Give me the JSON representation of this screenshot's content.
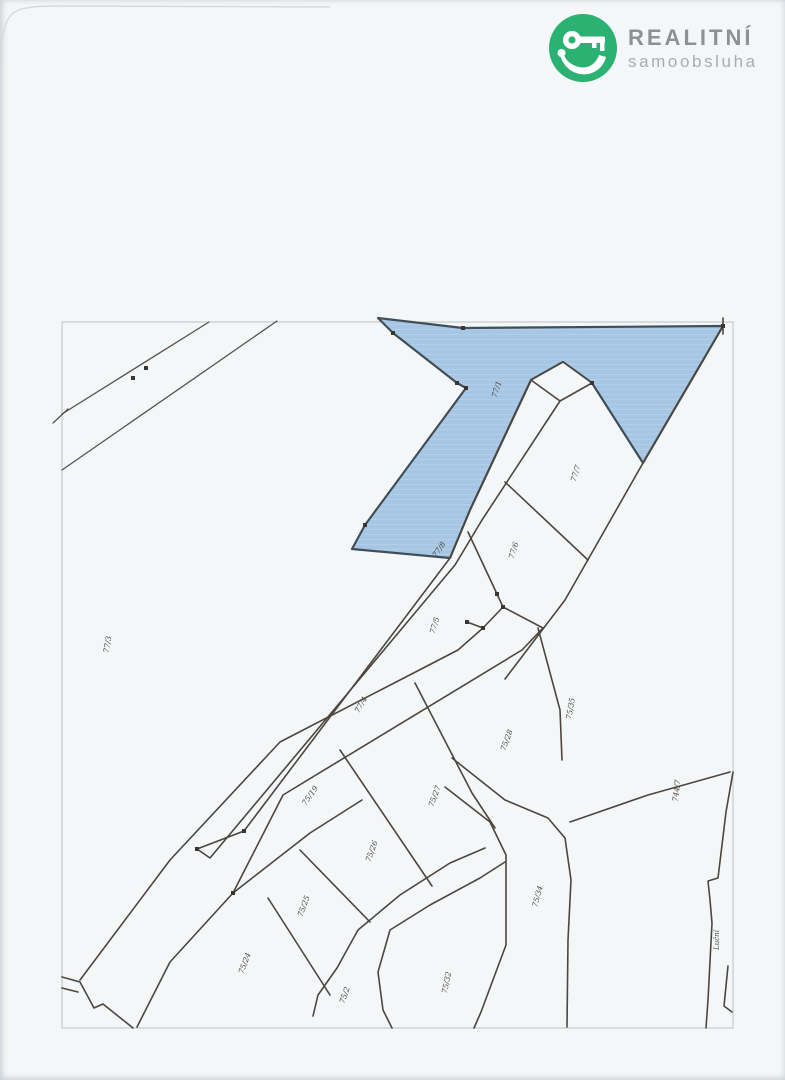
{
  "page": {
    "background": "#f4f7f8",
    "kind": "scanned cadastral map sheet"
  },
  "logo": {
    "line1": "REALITNÍ",
    "line2": "samoobsluha",
    "icon": "key-hand-icon",
    "circle_color": "#2bb273",
    "line1_color": "#8e9093",
    "line2_color": "#a9adb1"
  },
  "map": {
    "type": "cadastral-map",
    "border_color": "#bcc2c6",
    "line_color": "#4d463e",
    "highlight": {
      "parcel": "77/1",
      "fill": "#a6c6e4",
      "outline": "#414e58"
    },
    "labels": [
      {
        "text": "77/1",
        "x": 499,
        "y": 390,
        "rot": -73
      },
      {
        "text": "77/7",
        "x": 578,
        "y": 474,
        "rot": -73
      },
      {
        "text": "77/6",
        "x": 516,
        "y": 551,
        "rot": -73
      },
      {
        "text": "77/8",
        "x": 441,
        "y": 551,
        "rot": -55
      },
      {
        "text": "77/5",
        "x": 437,
        "y": 626,
        "rot": -73
      },
      {
        "text": "77/4",
        "x": 363,
        "y": 706,
        "rot": -60
      },
      {
        "text": "77/3",
        "x": 110,
        "y": 645,
        "rot": -80
      },
      {
        "text": "75/19",
        "x": 312,
        "y": 797,
        "rot": -55
      },
      {
        "text": "75/35",
        "x": 573,
        "y": 709,
        "rot": -80
      },
      {
        "text": "75/28",
        "x": 509,
        "y": 741,
        "rot": -70
      },
      {
        "text": "75/27",
        "x": 437,
        "y": 797,
        "rot": -70
      },
      {
        "text": "75/26",
        "x": 374,
        "y": 852,
        "rot": -70
      },
      {
        "text": "75/25",
        "x": 306,
        "y": 907,
        "rot": -70
      },
      {
        "text": "75/24",
        "x": 247,
        "y": 964,
        "rot": -70
      },
      {
        "text": "75/34",
        "x": 540,
        "y": 897,
        "rot": -75
      },
      {
        "text": "75/32",
        "x": 449,
        "y": 983,
        "rot": -78
      },
      {
        "text": "75/2",
        "x": 347,
        "y": 996,
        "rot": -70
      },
      {
        "text": "744/7",
        "x": 679,
        "y": 791,
        "rot": -83
      },
      {
        "text": "Luční",
        "x": 719,
        "y": 940,
        "rot": -90,
        "kind": "street"
      }
    ]
  }
}
